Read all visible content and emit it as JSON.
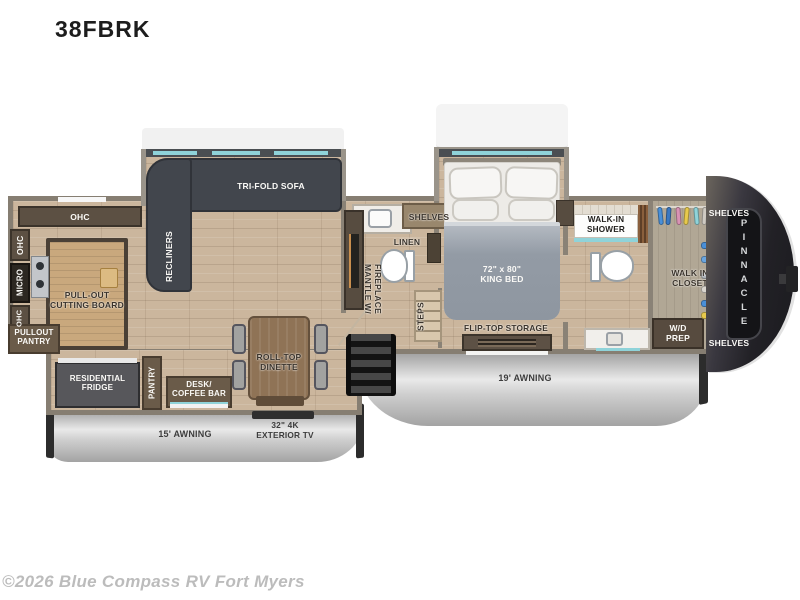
{
  "title": "38FBRK",
  "footer": {
    "copyright": "©2026 Blue Compass RV Fort Myers"
  },
  "brand": {
    "name": "PINNACLE"
  },
  "exterior": {
    "awning_left": "15' AWNING",
    "awning_right": "19' AWNING",
    "exterior_tv": "32\" 4K\nEXTERIOR TV"
  },
  "kitchen": {
    "ohc_top": "OHC",
    "ohc_upper": "OHC",
    "micro": "MICRO",
    "ohc_lower": "OHC",
    "pullout_pantry": "PULLOUT\nPANTRY",
    "cutting_board": "PULL-OUT\nCUTTING BOARD"
  },
  "living": {
    "recliners": "RECLINERS",
    "sofa": "TRI-FOLD SOFA",
    "fireplace": "MANTLE W/\nFIREPLACE",
    "dinette": "ROLL-TOP\nDINETTE"
  },
  "slide_left": {
    "fridge": "RESIDENTIAL\nFRIDGE",
    "pantry": "PANTRY",
    "desk": "DESK/\nCOFFEE BAR"
  },
  "mid_bath": {
    "shelves": "SHELVES",
    "linen": "LINEN",
    "steps": "STEPS"
  },
  "bedroom": {
    "king_bed": "72\" x 80\"\nKING BED",
    "flip_top_storage": "FLIP-TOP STORAGE"
  },
  "front_bath": {
    "shower": "WALK-IN\nSHOWER"
  },
  "closet": {
    "shelves_top": "SHELVES",
    "walk_in": "WALK IN\nCLOSET",
    "wd_prep": "W/D\nPREP",
    "shelves_bottom": "SHELVES"
  },
  "colors": {
    "floor": "#cbb69d",
    "wall": "#8a8276",
    "cabinet": "#5c5043",
    "sofa": "#42464d",
    "awning_silver": "#c9c9c9",
    "window_accent": "#8fd3d9",
    "front_cap": "#222126"
  }
}
